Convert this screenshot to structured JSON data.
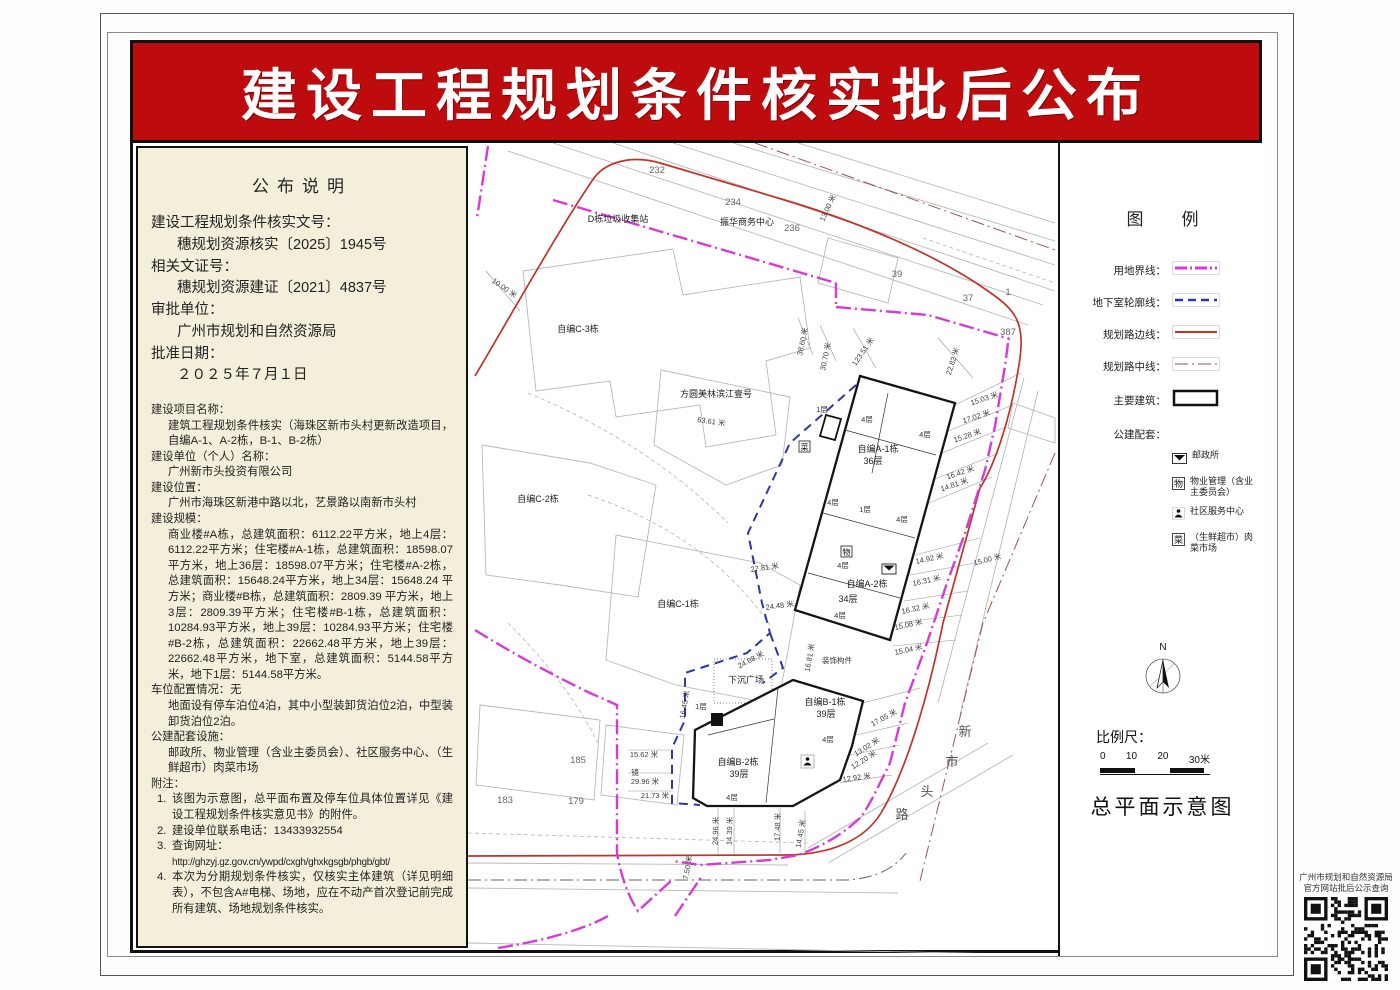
{
  "page": {
    "banner_title": "建设工程规划条件核实批后公布"
  },
  "announcement": {
    "title": "公布说明",
    "top_fields": [
      {
        "label": "建设工程规划条件核实文号：",
        "value": "穗规划资源核实〔2025〕1945号"
      },
      {
        "label": "相关文证号：",
        "value": "穗规划资源建证〔2021〕4837号"
      },
      {
        "label": "审批单位：",
        "value": "广州市规划和自然资源局"
      },
      {
        "label": "批准日期：",
        "value": "２０２５年７月１日"
      }
    ],
    "fields": [
      {
        "label": "建设项目名称：",
        "value": "建筑工程规划条件核实（海珠区新市头村更新改造项目，自编A-1、A-2栋，B-1、B-2栋）"
      },
      {
        "label": "建设单位（个人）名称：",
        "value": "广州新市头投资有限公司"
      },
      {
        "label": "建设位置：",
        "value": "广州市海珠区新港中路以北，艺景路以南新市头村"
      },
      {
        "label": "建设规模：",
        "value": "商业楼#A栋，总建筑面积：6112.22平方米，地上4层：6112.22平方米；住宅楼#A-1栋，总建筑面积：18598.07平方米，地上36层：18598.07平方米；住宅楼#A-2栋，总建筑面积：15648.24平方米，地上34层：15648.24 平方米；商业楼#B栋，总建筑面积：2809.39 平方米，地上3层：2809.39平方米；住宅楼#B-1栋，总建筑面积：10284.93平方米，地上39层：10284.93平方米；住宅楼#B-2栋，总建筑面积：22662.48平方米，地上39层：22662.48平方米，地下室，总建筑面积：5144.58平方米，地下1层：5144.58平方米。"
      },
      {
        "label": "车位配置情况：无",
        "value": "地面设有停车泊位4泊，其中小型装卸货泊位2泊，中型装卸货泊位2泊。"
      },
      {
        "label": "公建配套设施：",
        "value": "邮政所、物业管理（含业主委员会）、社区服务中心、（生鲜超市）肉菜市场"
      }
    ],
    "notes_label": "附注：",
    "notes": [
      {
        "num": "1.",
        "text": "该图为示意图，总平面布置及停车位具体位置详见《建设工程规划条件核实意见书》的附件。"
      },
      {
        "num": "2.",
        "text": "建设单位联系电话：13433932554"
      },
      {
        "num": "3.",
        "text": "查询网址：",
        "text2": "http://ghzyj.gz.gov.cn/ywpd/cxgh/ghxkgsgb/phgb/gbt/"
      },
      {
        "num": "4.",
        "text": "本次为分期规划条件核实，仅核实主体建筑（详见明细表），不包含A#电梯、场地，应在不动产首次登记前完成所有建筑、场地规划条件核实。"
      }
    ]
  },
  "legend": {
    "title": "图例",
    "items": [
      {
        "label": "用地界线：",
        "type": "boundary"
      },
      {
        "label": "地下室轮廓线：",
        "type": "basement"
      },
      {
        "label": "规划路边线：",
        "type": "road-edge"
      },
      {
        "label": "规划路中线：",
        "type": "road-center"
      },
      {
        "label": "主要建筑：",
        "type": "building"
      },
      {
        "label": "公建配套：",
        "type": "public"
      }
    ],
    "public_items": [
      {
        "icon": "post-office",
        "label": "邮政所"
      },
      {
        "icon": "property-mgmt",
        "char": "物",
        "label": "物业管理（含业主委员会）"
      },
      {
        "icon": "community-center",
        "label": "社区服务中心"
      },
      {
        "icon": "market",
        "char": "菜",
        "label": "（生鲜超市）肉菜市场"
      }
    ],
    "colors": {
      "boundary": "#d63bd6",
      "basement": "#2b3a9c",
      "road_edge": "#c23227",
      "road_center": "#a3524a",
      "building": "#111111"
    }
  },
  "compass": {
    "label": "N"
  },
  "scale": {
    "label": "比例尺：",
    "ticks": [
      "0",
      "10",
      "20",
      "30米"
    ]
  },
  "footer": {
    "map_title": "总平面示意图"
  },
  "qr": {
    "caption_line1": "广州市规划和自然资源局",
    "caption_line2": "官方网站批后公示查询"
  },
  "map": {
    "labels": [
      {
        "t": "232",
        "x": 189,
        "y": 30,
        "k": "p"
      },
      {
        "t": "234",
        "x": 265,
        "y": 62,
        "k": "p"
      },
      {
        "t": "振华商务中心",
        "x": 279,
        "y": 82,
        "k": "n"
      },
      {
        "t": "236",
        "x": 324,
        "y": 88,
        "k": "p"
      },
      {
        "t": "13.00 米",
        "x": 362,
        "y": 66,
        "r": -65,
        "k": "d"
      },
      {
        "t": "D栋垃圾收集站",
        "x": 150,
        "y": 79,
        "k": "n"
      },
      {
        "t": "39",
        "x": 429,
        "y": 134,
        "k": "p"
      },
      {
        "t": "37",
        "x": 500,
        "y": 158,
        "k": "p"
      },
      {
        "t": "1",
        "x": 540,
        "y": 152,
        "k": "p"
      },
      {
        "t": "387",
        "x": 540,
        "y": 192,
        "k": "p"
      },
      {
        "t": "10.00 米",
        "x": 35,
        "y": 147,
        "r": 35,
        "k": "d"
      },
      {
        "t": "自编C-3栋",
        "x": 110,
        "y": 189,
        "k": "n"
      },
      {
        "t": "方圆美林滨江壹号",
        "x": 248,
        "y": 254,
        "k": "n"
      },
      {
        "t": "63.61 米",
        "x": 243,
        "y": 281,
        "r": 8,
        "k": "d"
      },
      {
        "t": "38.60 米",
        "x": 337,
        "y": 199,
        "r": -78,
        "k": "d"
      },
      {
        "t": "30.70 米",
        "x": 360,
        "y": 214,
        "r": -78,
        "k": "d"
      },
      {
        "t": "123.51 米",
        "x": 397,
        "y": 210,
        "r": -55,
        "k": "d"
      },
      {
        "t": "22.82 米",
        "x": 487,
        "y": 219,
        "r": -72,
        "k": "d"
      },
      {
        "t": "15.03 米",
        "x": 517,
        "y": 258,
        "r": -18,
        "k": "d"
      },
      {
        "t": "17.02 米",
        "x": 509,
        "y": 276,
        "r": -18,
        "k": "d"
      },
      {
        "t": "15.28 米",
        "x": 500,
        "y": 295,
        "r": -18,
        "k": "d"
      },
      {
        "t": "16.42 米",
        "x": 493,
        "y": 332,
        "r": -18,
        "k": "d"
      },
      {
        "t": "14.81 米",
        "x": 487,
        "y": 344,
        "r": -18,
        "k": "d"
      },
      {
        "t": "1层",
        "x": 354,
        "y": 269,
        "k": "s"
      },
      {
        "t": "4层",
        "x": 399,
        "y": 279,
        "k": "s"
      },
      {
        "t": "4层",
        "x": 457,
        "y": 294,
        "k": "s"
      },
      {
        "t": "自编A-1栋",
        "x": 410,
        "y": 309,
        "k": "n"
      },
      {
        "t": "36层",
        "x": 405,
        "y": 321,
        "k": "n"
      },
      {
        "t": "4层",
        "x": 365,
        "y": 362,
        "k": "s"
      },
      {
        "t": "1层",
        "x": 397,
        "y": 369,
        "k": "s"
      },
      {
        "t": "4层",
        "x": 434,
        "y": 379,
        "k": "s"
      },
      {
        "t": "14.92 米",
        "x": 462,
        "y": 418,
        "r": -12,
        "k": "d"
      },
      {
        "t": "15.00 米",
        "x": 520,
        "y": 419,
        "r": -15,
        "k": "d"
      },
      {
        "t": "16.31 米",
        "x": 459,
        "y": 440,
        "r": -12,
        "k": "d"
      },
      {
        "t": "4层",
        "x": 375,
        "y": 425,
        "k": "s"
      },
      {
        "t": "自编A-2栋",
        "x": 399,
        "y": 444,
        "k": "n"
      },
      {
        "t": "34层",
        "x": 380,
        "y": 459,
        "k": "n"
      },
      {
        "t": "16.32 米",
        "x": 448,
        "y": 468,
        "r": -12,
        "k": "d"
      },
      {
        "t": "4层",
        "x": 372,
        "y": 475,
        "k": "s"
      },
      {
        "t": "15.08 米",
        "x": 441,
        "y": 484,
        "r": -12,
        "k": "d"
      },
      {
        "t": "15.04 米",
        "x": 441,
        "y": 509,
        "r": -12,
        "k": "d"
      },
      {
        "t": "16.81 米",
        "x": 344,
        "y": 515,
        "r": -80,
        "k": "d"
      },
      {
        "t": "装饰构件",
        "x": 369,
        "y": 520,
        "k": "s"
      },
      {
        "t": "自编C-2栋",
        "x": 70,
        "y": 359,
        "k": "n"
      },
      {
        "t": "自编C-1栋",
        "x": 210,
        "y": 464,
        "k": "n"
      },
      {
        "t": "27.81 米",
        "x": 297,
        "y": 427,
        "r": -8,
        "k": "d"
      },
      {
        "t": "24.48 米",
        "x": 312,
        "y": 465,
        "r": -8,
        "k": "d"
      },
      {
        "t": "24.68 米",
        "x": 284,
        "y": 519,
        "r": -28,
        "k": "d"
      },
      {
        "t": "下沉广场",
        "x": 278,
        "y": 540,
        "k": "n"
      },
      {
        "t": "16.45 米",
        "x": 219,
        "y": 562,
        "r": -80,
        "k": "d"
      },
      {
        "t": "1层",
        "x": 233,
        "y": 566,
        "k": "s"
      },
      {
        "t": "自编B-1栋",
        "x": 357,
        "y": 562,
        "k": "n"
      },
      {
        "t": "39层",
        "x": 358,
        "y": 574,
        "k": "n"
      },
      {
        "t": "17.05 米",
        "x": 417,
        "y": 577,
        "r": -28,
        "k": "d"
      },
      {
        "t": "4层",
        "x": 360,
        "y": 599,
        "k": "s"
      },
      {
        "t": "13.02 米",
        "x": 400,
        "y": 606,
        "r": -32,
        "k": "d"
      },
      {
        "t": "12.20 米",
        "x": 397,
        "y": 619,
        "r": -32,
        "k": "d"
      },
      {
        "t": "自编B-2栋",
        "x": 270,
        "y": 622,
        "k": "n"
      },
      {
        "t": "39层",
        "x": 271,
        "y": 634,
        "k": "n"
      },
      {
        "t": "12.92 米",
        "x": 389,
        "y": 637,
        "r": -8,
        "k": "d"
      },
      {
        "t": "4层",
        "x": 264,
        "y": 657,
        "k": "s"
      },
      {
        "t": "21.73 米",
        "x": 187,
        "y": 655,
        "k": "d"
      },
      {
        "t": "24.96 米",
        "x": 250,
        "y": 688,
        "r": -88,
        "k": "d"
      },
      {
        "t": "14.39 米",
        "x": 264,
        "y": 688,
        "r": -88,
        "k": "d"
      },
      {
        "t": "17.48 米",
        "x": 312,
        "y": 684,
        "r": -88,
        "k": "d"
      },
      {
        "t": "14.45 米",
        "x": 335,
        "y": 691,
        "r": -80,
        "k": "d"
      },
      {
        "t": "7.50 米",
        "x": 222,
        "y": 725,
        "r": -80,
        "k": "d"
      },
      {
        "t": "185",
        "x": 110,
        "y": 620,
        "k": "p"
      },
      {
        "t": "183",
        "x": 37,
        "y": 660,
        "k": "p"
      },
      {
        "t": "179",
        "x": 108,
        "y": 661,
        "k": "p"
      },
      {
        "t": "15.62 米",
        "x": 176,
        "y": 614,
        "k": "d"
      },
      {
        "t": "镜",
        "x": 167,
        "y": 632,
        "k": "s"
      },
      {
        "t": "29.96 米",
        "x": 177,
        "y": 641,
        "k": "d"
      },
      {
        "t": "新",
        "x": 497,
        "y": 593,
        "k": "r"
      },
      {
        "t": "市",
        "x": 484,
        "y": 623,
        "k": "r"
      },
      {
        "t": "头",
        "x": 459,
        "y": 653,
        "k": "r"
      },
      {
        "t": "路",
        "x": 434,
        "y": 676,
        "k": "r"
      }
    ],
    "icons": [
      {
        "type": "market",
        "char": "菜",
        "x": 331,
        "y": 298
      },
      {
        "type": "property",
        "char": "物",
        "x": 373,
        "y": 403
      },
      {
        "type": "post",
        "x": 414,
        "y": 421
      },
      {
        "type": "community",
        "x": 333,
        "y": 612
      }
    ]
  }
}
